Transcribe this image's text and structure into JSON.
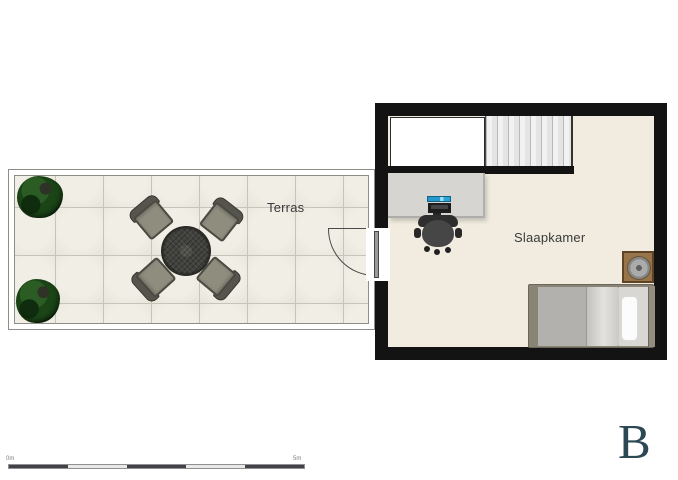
{
  "page": {
    "background": "#ffffff"
  },
  "branding": {
    "logo_letter": "B",
    "logo_color": "#2c4854"
  },
  "floorplan": {
    "rooms": {
      "terras": {
        "label": "Terras"
      },
      "slaapkamer": {
        "label": "Slaapkamer"
      }
    },
    "furniture": {
      "terras": [
        "plant",
        "plant",
        "round-dining-table",
        "patio-chair",
        "patio-chair",
        "patio-chair",
        "patio-chair",
        "door-swing"
      ],
      "slaapkamer": [
        "staircase",
        "stair-void",
        "desk",
        "computer-monitor",
        "keyboard",
        "office-chair",
        "nightstand",
        "table-lamp",
        "single-bed",
        "pillow",
        "door"
      ]
    },
    "colors": {
      "wall": "#131313",
      "bedroom_floor": "#f1ecdf",
      "terrace_tile": "#ebe8df",
      "tile_grout": "#c7c4b9",
      "plant_green": "#1b4517",
      "monitor_screen": "#2aa4d8",
      "nightstand_wood": "#97744a",
      "bed_mattress": "#b3b1ad"
    }
  },
  "scale_bar": {
    "start_label": "0m",
    "end_label": "5m",
    "segment_count": 5
  }
}
